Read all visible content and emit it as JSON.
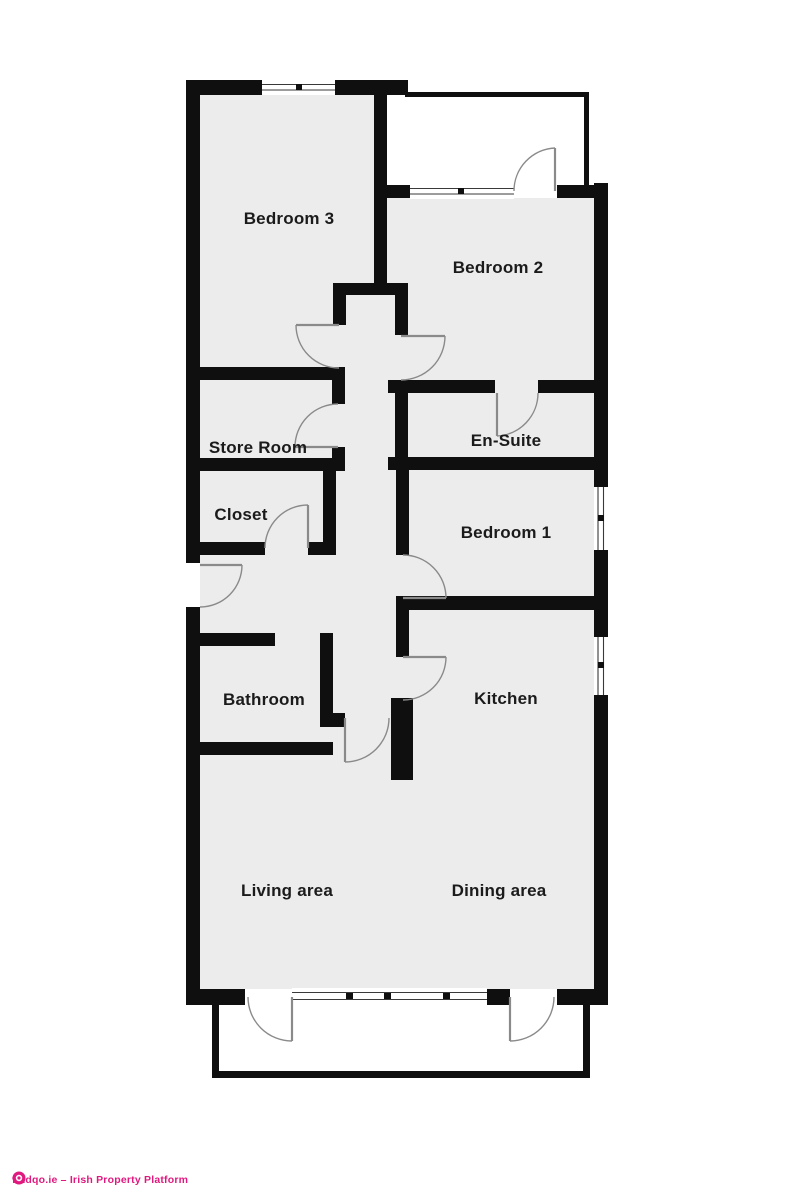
{
  "plan": {
    "title": "Apartment floor plan",
    "rooms": [
      {
        "label": "Bedroom 3"
      },
      {
        "label": "Bedroom 2"
      },
      {
        "label": "Store Room"
      },
      {
        "label": "En-Suite"
      },
      {
        "label": "Closet"
      },
      {
        "label": "Bedroom 1"
      },
      {
        "label": "Bathroom"
      },
      {
        "label": "Kitchen"
      },
      {
        "label": "Living area"
      },
      {
        "label": "Dining area"
      }
    ],
    "colors": {
      "wall": "#0f0f0f",
      "floor": "#ececec",
      "background": "#ffffff",
      "door": "#8a8a8a",
      "window": "#3a3a3a",
      "text": "#1b1b1b"
    }
  },
  "footer": {
    "text": "findqo.ie – Irish Property Platform",
    "color": "#e0197f"
  }
}
